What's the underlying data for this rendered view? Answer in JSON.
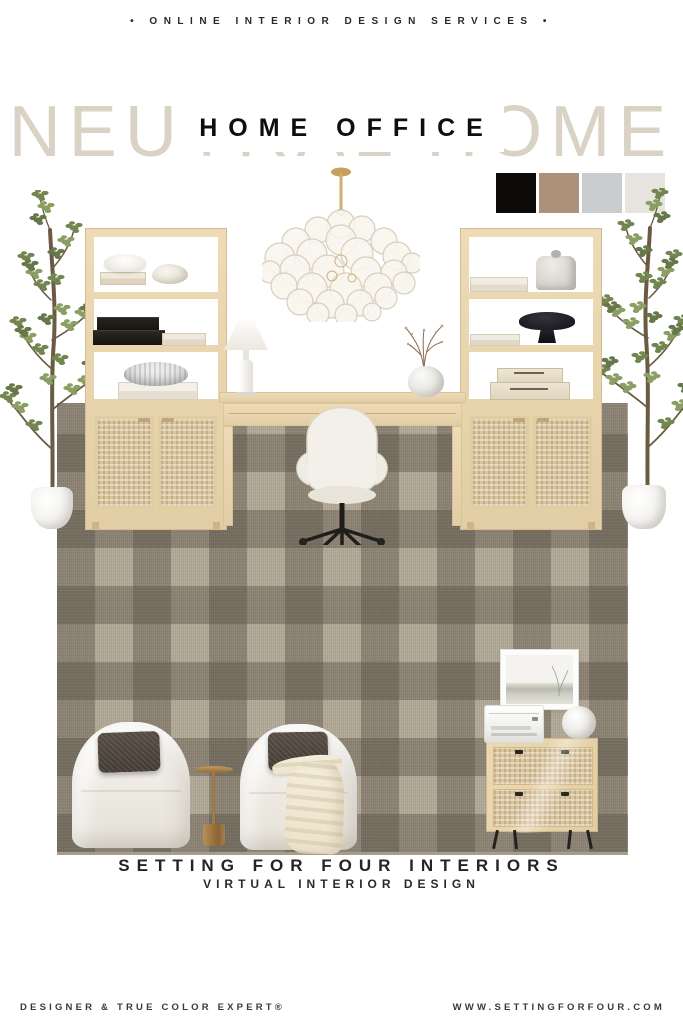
{
  "header": {
    "tagline": "• ONLINE INTERIOR DESIGN SERVICES •"
  },
  "hero": {
    "watermark": "NEUTRAL HOME",
    "title": "HOME OFFICE"
  },
  "palette": {
    "colors": [
      {
        "name": "black",
        "hex": "#0D0B09"
      },
      {
        "name": "camel",
        "hex": "#AC9279"
      },
      {
        "name": "light-gray",
        "hex": "#CBCCCE"
      },
      {
        "name": "ivory",
        "hex": "#E8E5E0"
      }
    ]
  },
  "materials": {
    "rug_base": "#B4AA98",
    "rug_check": "#544C42",
    "oak_wood": "#E6D2AB",
    "cane": "#D9C49C",
    "brass_gold": "#B28B52"
  },
  "scene": {
    "items": [
      "bubble glass chandelier with brass stem",
      "faux olive tree in white planter (left)",
      "faux olive tree in white planter (right)",
      "light oak bookshelf tower with cane cabinet (left)",
      "light oak bookshelf tower with cane cabinet (right)",
      "light oak writing desk",
      "white upholstered swivel desk chair",
      "white table lamp",
      "round vase with branches",
      "taupe plaid area rug",
      "white barrel swivel chair (left)",
      "white barrel swivel chair (right)",
      "charcoal lumbar pillows",
      "gold martini accent table",
      "cream throw blanket",
      "framed landscape art",
      "white printer",
      "white round vase",
      "cane two-drawer file cabinet"
    ]
  },
  "titles": {
    "studio": "SETTING FOR FOUR INTERIORS",
    "subtitle": "VIRTUAL INTERIOR DESIGN"
  },
  "footer": {
    "left": "DESIGNER & TRUE COLOR EXPERT®",
    "right": "WWW.SETTINGFORFOUR.COM"
  }
}
